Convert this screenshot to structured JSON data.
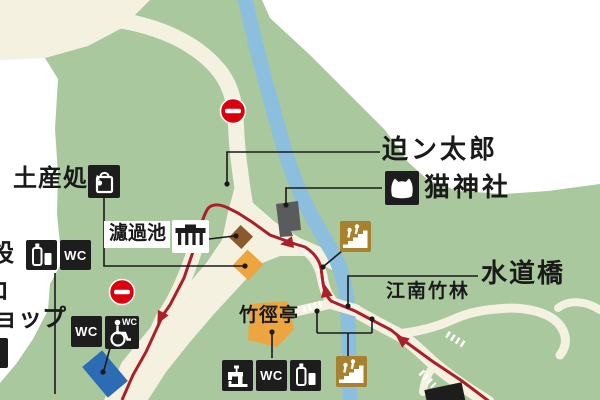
{
  "map": {
    "place_labels": {
      "sakon_taro": "迫ン太郎",
      "neko_jinja": "猫神社",
      "miyage_dokoro": "土産処",
      "rokachi": "濾過池",
      "suido_bashi": "水道橋",
      "konan_chikurin": "江南竹林",
      "chikukei_tei": "竹徑亭",
      "partial_left_line1": "設",
      "partial_left_line2": "ロ",
      "partial_left_line3": "ョップ"
    },
    "icon_labels": {
      "wc": "WC"
    },
    "icons": {
      "souvenir": "shopping-bag-icon",
      "drink": "bottled-drink-icon",
      "toilet": "wc-icon",
      "accessible_toilet": "wheelchair-wc-icon",
      "fountain": "drinking-fountain-icon",
      "cat_shrine": "cat-icon",
      "stairs": "stairs-icon",
      "filtration": "filtration-structure-icon",
      "no_entry": "no-entry-icon"
    },
    "colors": {
      "terrain_green": "#a9c89e",
      "road_cream": "#f4f1e0",
      "river_blue": "#8cbedd",
      "route_red": "#ab1f28",
      "no_entry_red": "#dc000c",
      "icon_black": "#1d1d1e",
      "stairs_brown": "#a8812f",
      "orange_building": "#eda540",
      "brown_building": "#8a5a2c",
      "blue_building": "#2b6cb4",
      "gray_building": "#595b5d"
    }
  }
}
